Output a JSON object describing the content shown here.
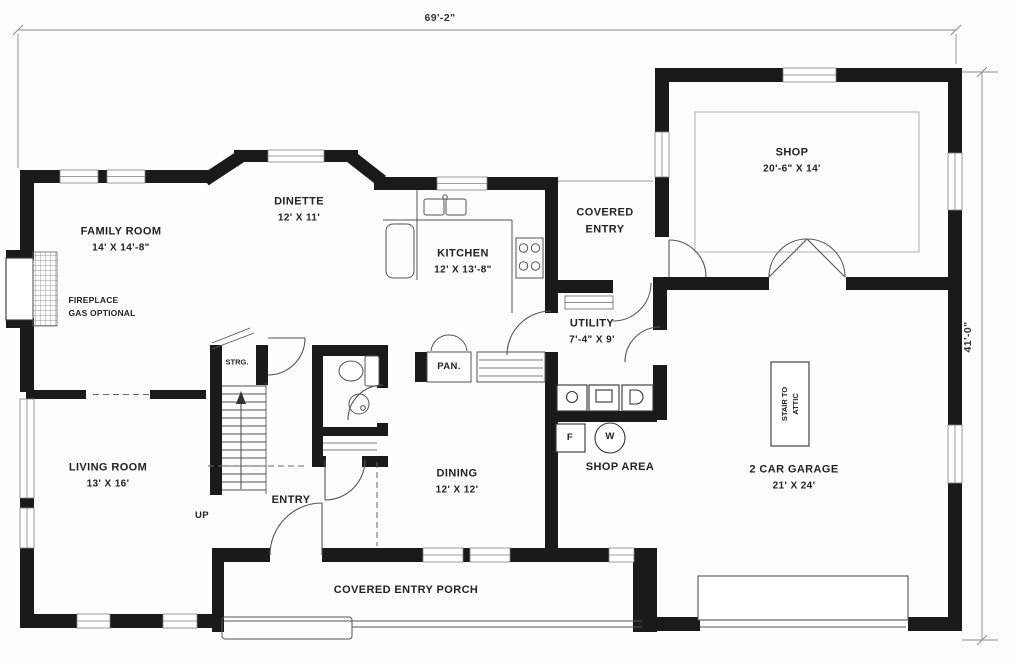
{
  "plan": {
    "dim_top": "69'-2\"",
    "dim_right": "41'-0\"",
    "rooms": {
      "family_room": {
        "name": "FAMILY ROOM",
        "size": "14' X 14'-8\""
      },
      "dinette": {
        "name": "DINETTE",
        "size": "12' X 11'"
      },
      "kitchen": {
        "name": "KITCHEN",
        "size": "12' X 13'-8\""
      },
      "covered_entry": {
        "name": "COVERED",
        "name2": "ENTRY"
      },
      "shop": {
        "name": "SHOP",
        "size": "20'-6\" X 14'"
      },
      "utility": {
        "name": "UTILITY",
        "size": "7'-4\" X 9'"
      },
      "living_room": {
        "name": "LIVING ROOM",
        "size": "13' X 16'"
      },
      "entry": {
        "name": "ENTRY"
      },
      "dining": {
        "name": "DINING",
        "size": "12' X 12'"
      },
      "shop_area": {
        "name": "SHOP AREA"
      },
      "garage": {
        "name": "2 CAR GARAGE",
        "size": "21' X 24'"
      },
      "porch": {
        "name": "COVERED ENTRY PORCH"
      }
    },
    "annotations": {
      "fireplace_1": "FIREPLACE",
      "fireplace_2": "GAS OPTIONAL",
      "pantry": "PAN.",
      "storage": "STRG.",
      "up": "UP",
      "attic_1": "STAIR TO",
      "attic_2": "ATTIC",
      "furnace": "F",
      "water_heater": "W"
    },
    "colors": {
      "wall": "#1a1a1a",
      "line": "#555555",
      "light_line": "#999999",
      "background": "#fdfdfd"
    }
  }
}
